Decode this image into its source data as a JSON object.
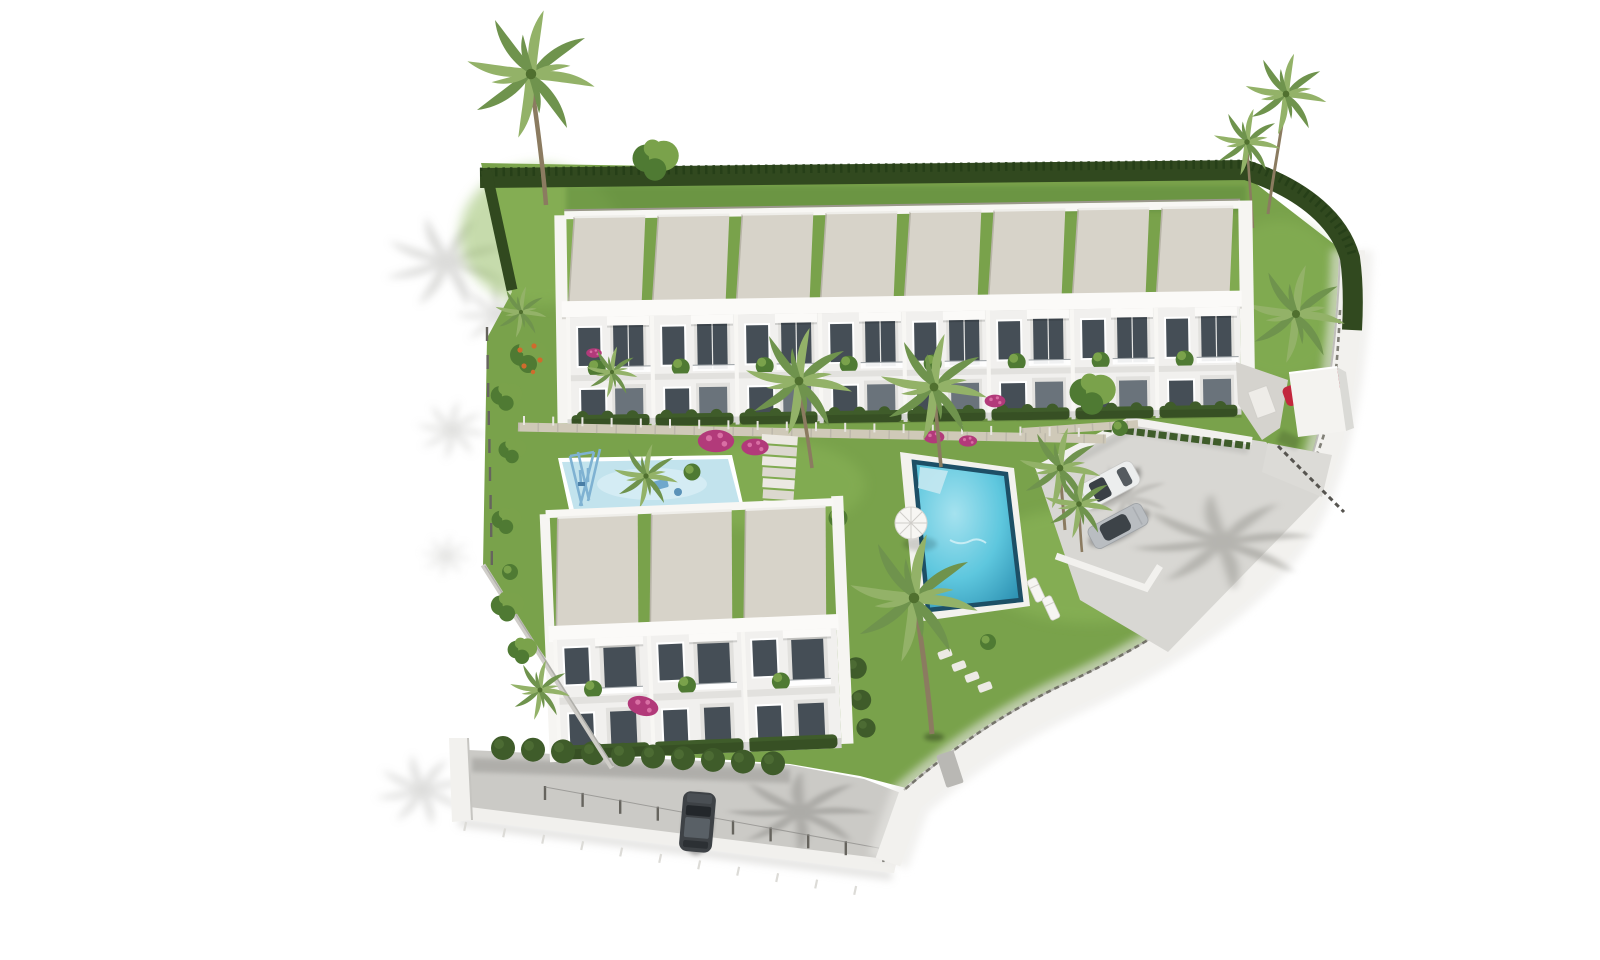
{
  "scene": {
    "description": "Aerial 3D architectural rendering of a white terraced-house complex with gardens, a main pool, a children's pool with swings, a parking area with cars, palm trees and a curved white perimeter wall on a plain white background",
    "counts": {
      "upper_units": 8,
      "lower_units": 3,
      "street_fence_posts": 10,
      "west_fence_posts": 9,
      "curb_ticks": 11,
      "front_fence_posts": 20,
      "lower_front_bushes": 10,
      "pools": 2,
      "vehicles": 4
    },
    "objects": {
      "buildings": [
        "terraced-row-8-units",
        "terraced-row-3-units"
      ],
      "amenities": [
        "main-pool",
        "kids-pool",
        "playground-swing",
        "parking-area",
        "entrance-canopy",
        "garden-stairs",
        "sun-loungers",
        "parasol"
      ],
      "vehicles": [
        "white-suv",
        "silver-sedan",
        "red-car-at-entrance",
        "dark-car-on-street"
      ]
    },
    "palette": {
      "grass": "#79a24b",
      "grassLight": "#8fb95c",
      "grassDark": "#5f8a3c",
      "hedge": "#31491f",
      "hedgeFront": "#3f5c2a",
      "foliage": "#4f7a33",
      "foliageLight": "#7aa24b",
      "palmA": "#6f934d",
      "palmB": "#93b268",
      "trunk": "#8b7b60",
      "roof": "#d7d3c9",
      "roofSeam": "#b8b4a8",
      "wall": "#f2f1ee",
      "wallLine": "#a9a8a4",
      "facade": "#f1f0ee",
      "facadeShade": "#e2e1de",
      "window": "#454e56",
      "windowLight": "#6a737b",
      "paving": "#cfc9b8",
      "street": "#cbcac6",
      "parking": "#d8d7d3",
      "poolEdge": "#1d4f66",
      "poolWater": "#4cbcd8",
      "poolLight": "#a5e2ef",
      "kidsPool": "#c2e3ed",
      "deck": "#f3f2ee",
      "pink": "#b23a7a",
      "pinkLight": "#d96fa4",
      "orange": "#cf6b2d",
      "red": "#c2273d",
      "carWhite": "#eceeee",
      "carSilver": "#b9bdc1",
      "swing": "#7fb2d2",
      "post": "#66645e"
    }
  }
}
